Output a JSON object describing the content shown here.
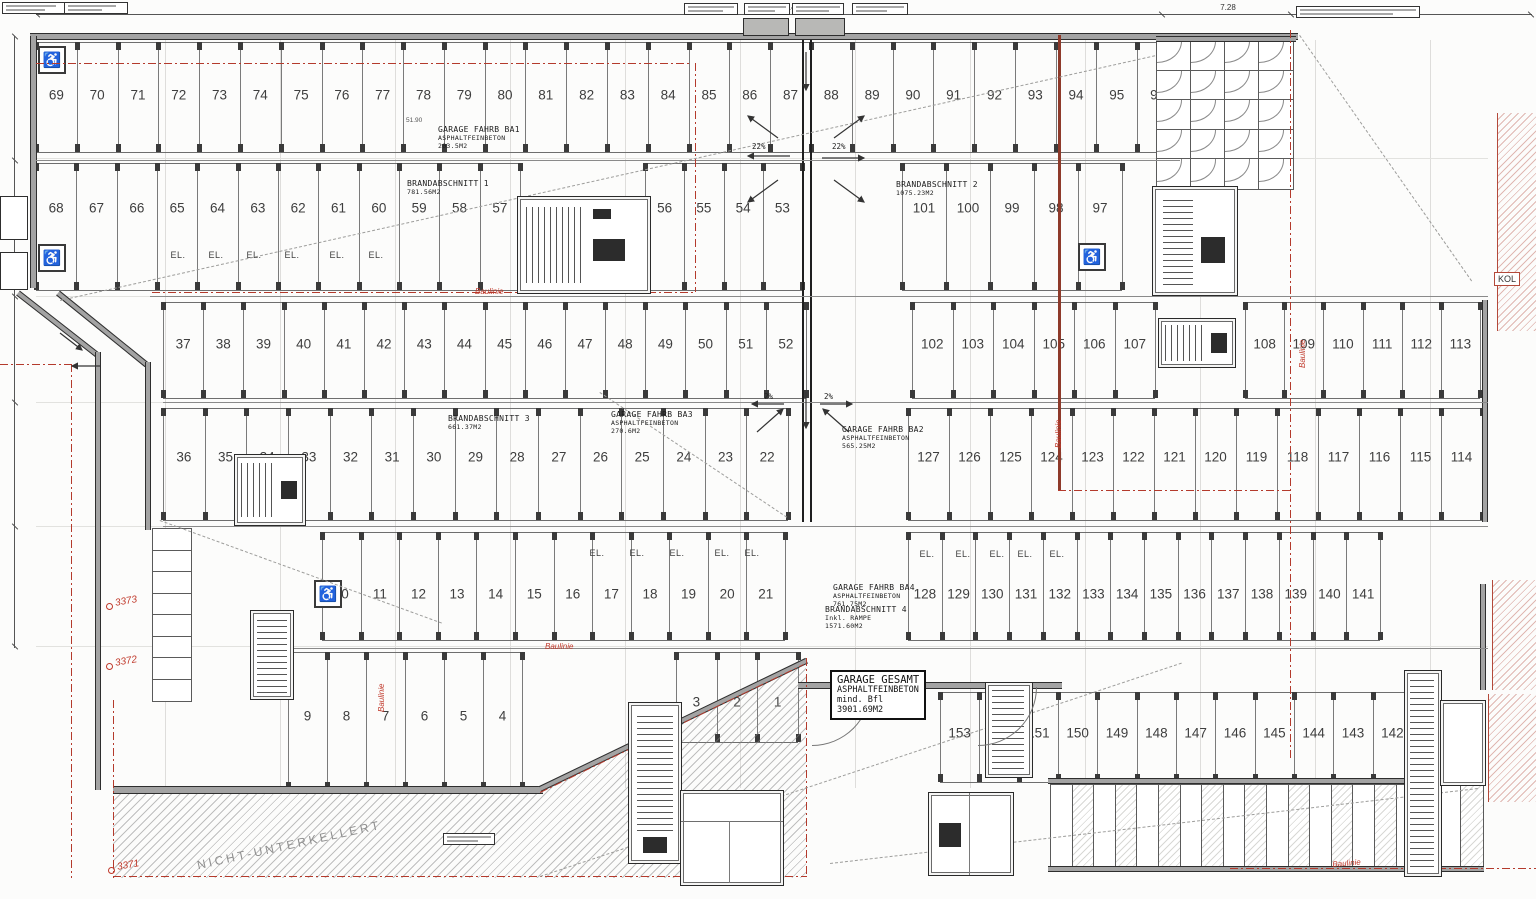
{
  "spaces": {
    "row_top": [
      "69",
      "70",
      "71",
      "72",
      "73",
      "74",
      "75",
      "76",
      "77",
      "78",
      "79",
      "80",
      "81",
      "82",
      "83",
      "84",
      "85",
      "86",
      "87",
      "88",
      "89",
      "90",
      "91",
      "92",
      "93",
      "94",
      "95",
      "96"
    ],
    "row_second_left": [
      "68",
      "67",
      "66",
      "65",
      "64",
      "63",
      "62",
      "61",
      "60",
      "59",
      "58",
      "57"
    ],
    "row_second_mid": [
      "56",
      "55",
      "54",
      "53"
    ],
    "row_second_right": [
      "101",
      "100",
      "99",
      "98",
      "97"
    ],
    "row_third_left": [
      "37",
      "38",
      "39",
      "40",
      "41",
      "42",
      "43",
      "44",
      "45",
      "46",
      "47",
      "48",
      "49",
      "50",
      "51",
      "52"
    ],
    "row_third_mid": [
      "102",
      "103",
      "104",
      "105",
      "106",
      "107"
    ],
    "row_third_right": [
      "108",
      "109",
      "110",
      "111",
      "112",
      "113"
    ],
    "row_fourth_left": [
      "36",
      "35",
      "34",
      "33",
      "32",
      "31",
      "30",
      "29",
      "28",
      "27",
      "26",
      "25",
      "24",
      "23",
      "22"
    ],
    "row_fourth_mid": [
      "127",
      "126",
      "125",
      "124"
    ],
    "row_fourth_right": [
      "123",
      "122",
      "121",
      "120",
      "119",
      "118",
      "117",
      "116",
      "115",
      "114"
    ],
    "row_fifth_left": [
      "10",
      "11",
      "12",
      "13",
      "14",
      "15",
      "16",
      "17",
      "18",
      "19",
      "20",
      "21"
    ],
    "row_fifth_right": [
      "128",
      "129",
      "130",
      "131",
      "132",
      "133",
      "134",
      "135",
      "136",
      "137",
      "138",
      "139",
      "140",
      "141"
    ],
    "row_sixth_left": [
      "9",
      "8",
      "7",
      "6",
      "5",
      "4"
    ],
    "row_sixth_mid": [
      "3",
      "2",
      "1"
    ],
    "row_bottom_right": [
      "153",
      "152",
      "151",
      "150",
      "149",
      "148",
      "147",
      "146",
      "145",
      "144",
      "143",
      "142"
    ]
  },
  "areas": {
    "ba1": [
      "GARAGE FAHRB BA1",
      "ASPHALTFEINBETON",
      "203.5M2"
    ],
    "ba2": [
      "GARAGE FAHRB BA2",
      "ASPHALTFEINBETON",
      "565.25M2"
    ],
    "ba3": [
      "GARAGE FAHRB BA3",
      "ASPHALTFEINBETON",
      "270.6M2"
    ],
    "ba4": [
      "GARAGE FAHRB BA4",
      "ASPHALTFEINBETON",
      "761.75M2"
    ],
    "b1": [
      "BRANDABSCHNITT 1",
      "781.56M2"
    ],
    "b2": [
      "BRANDABSCHNITT 2",
      "1075.23M2"
    ],
    "b3": [
      "BRANDABSCHNITT 3",
      "661.37M2"
    ],
    "b4": [
      "BRANDABSCHNITT 4",
      "Inkl. RAMPE",
      "1571.60M2"
    ],
    "total": [
      "GARAGE GESAMT",
      "ASPHALTFEINBETON",
      "mind. Bfl",
      "3901.69M2"
    ]
  },
  "annotations": {
    "el": "EL.",
    "baulinie": "Baulinie",
    "nicht_unterkellert": "NICHT-UNTERKELLERT",
    "kol": "KOL",
    "survey_points": [
      "3373",
      "3372",
      "3371"
    ],
    "slope_ramp": "22%",
    "slope_floor": "2%",
    "dim_total": "75.48",
    "dim_right": "7.28",
    "dim_garage": "51.90"
  },
  "icons": {
    "wheelchair": "♿"
  },
  "colors": {
    "red_line": "#b43a2c",
    "dark_red": "#8e3a2a",
    "wall_gray": "#a3a3a3",
    "line": "#6e6e6e",
    "paper": "#fcfcfb"
  }
}
